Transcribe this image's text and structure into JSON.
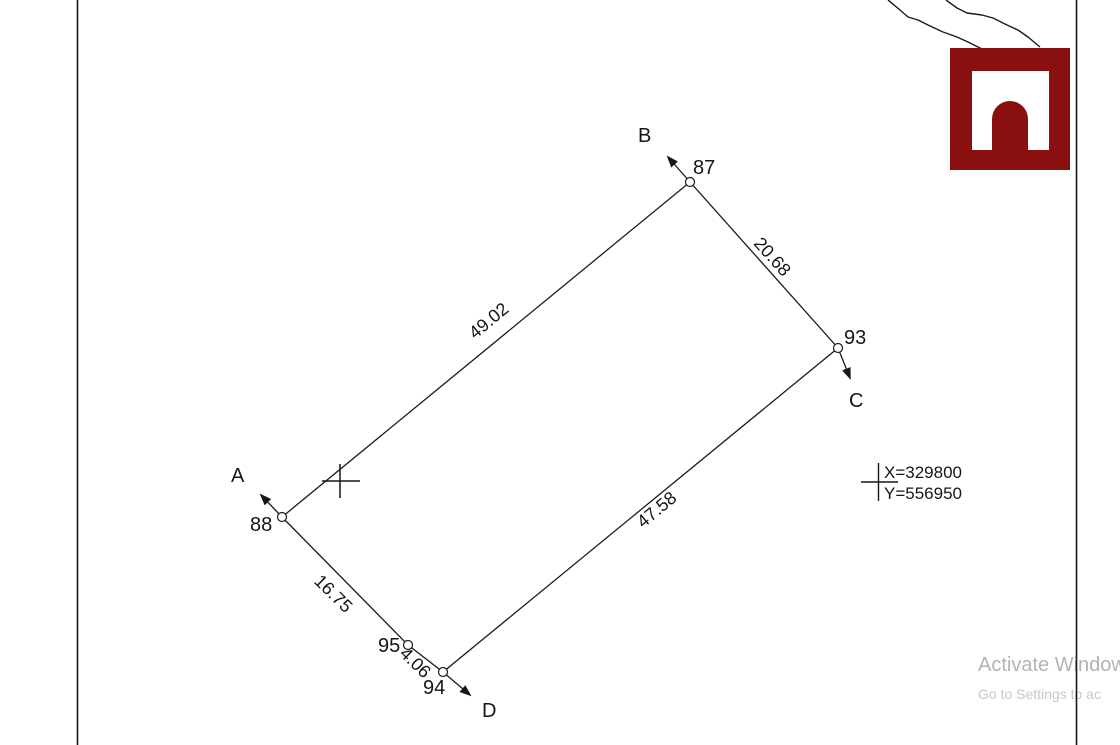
{
  "canvas": {
    "points": {
      "p87": "87",
      "p88": "88",
      "p93": "93",
      "p94": "94",
      "p95": "95"
    },
    "directions": {
      "a": "A",
      "b": "B",
      "c": "C",
      "d": "D"
    },
    "distances": {
      "side_88_87": "49.02",
      "side_87_93": "20.68",
      "side_93_94": "47.58",
      "side_88_95": "16.75",
      "side_95_94": "4.06"
    },
    "readout": {
      "x": "X=329800",
      "y": "Y=556950"
    }
  },
  "watermark": {
    "line1": "Activate Windows",
    "line2": "Go to Settings to ac"
  },
  "colors": {
    "logo_red": "#8a0f0f",
    "line_black": "#1a1a1a",
    "watermark_line1": "#b3b3b3",
    "watermark_line2": "#c7c7c7"
  }
}
